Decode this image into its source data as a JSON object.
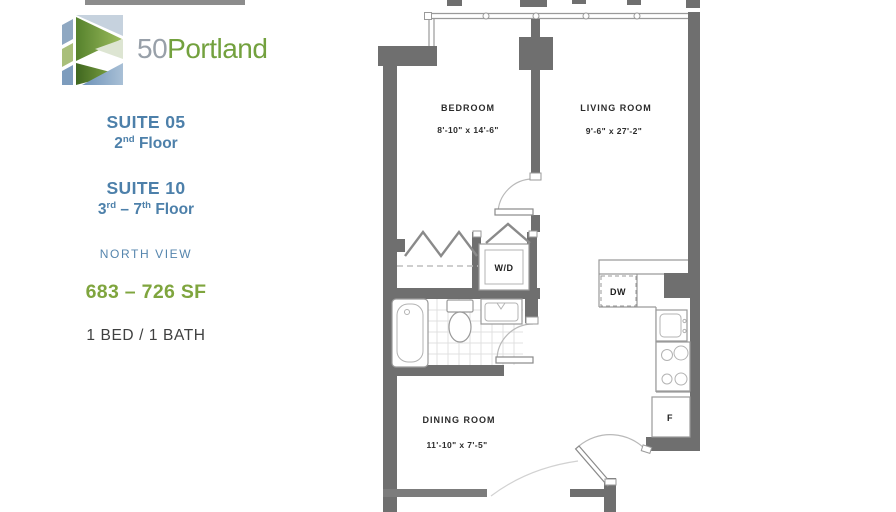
{
  "brand": {
    "number": "50",
    "name": "Portland"
  },
  "info": {
    "suite05": {
      "title": "SUITE 05",
      "floor": {
        "p1": "2",
        "sup1": "nd",
        "p2": " Floor"
      }
    },
    "suite10": {
      "title": "SUITE 10",
      "floor": {
        "p1": "3",
        "sup1": "rd",
        "p2": " – 7",
        "sup2": "th",
        "p3": " Floor"
      }
    },
    "view": "NORTH VIEW",
    "area": "683 – 726 SF",
    "bed_bath": "1 BED / 1 BATH"
  },
  "floorplan": {
    "rooms": [
      {
        "name": "BEDROOM",
        "dims": "8'-10\" x 14'-6\""
      },
      {
        "name": "LIVING ROOM",
        "dims": "9'-6\" x 27'-2\""
      },
      {
        "name": "DINING ROOM",
        "dims": "11'-10\" x 7'-5\""
      }
    ],
    "appliances": {
      "washer_dryer": "W/D",
      "dishwasher": "DW",
      "fridge": "F"
    }
  },
  "colors": {
    "accent_blue": "#4d80aa",
    "accent_green": "#7fa53e",
    "logo_gray": "#98a0a9",
    "wall_gray": "#6f6f6f"
  }
}
